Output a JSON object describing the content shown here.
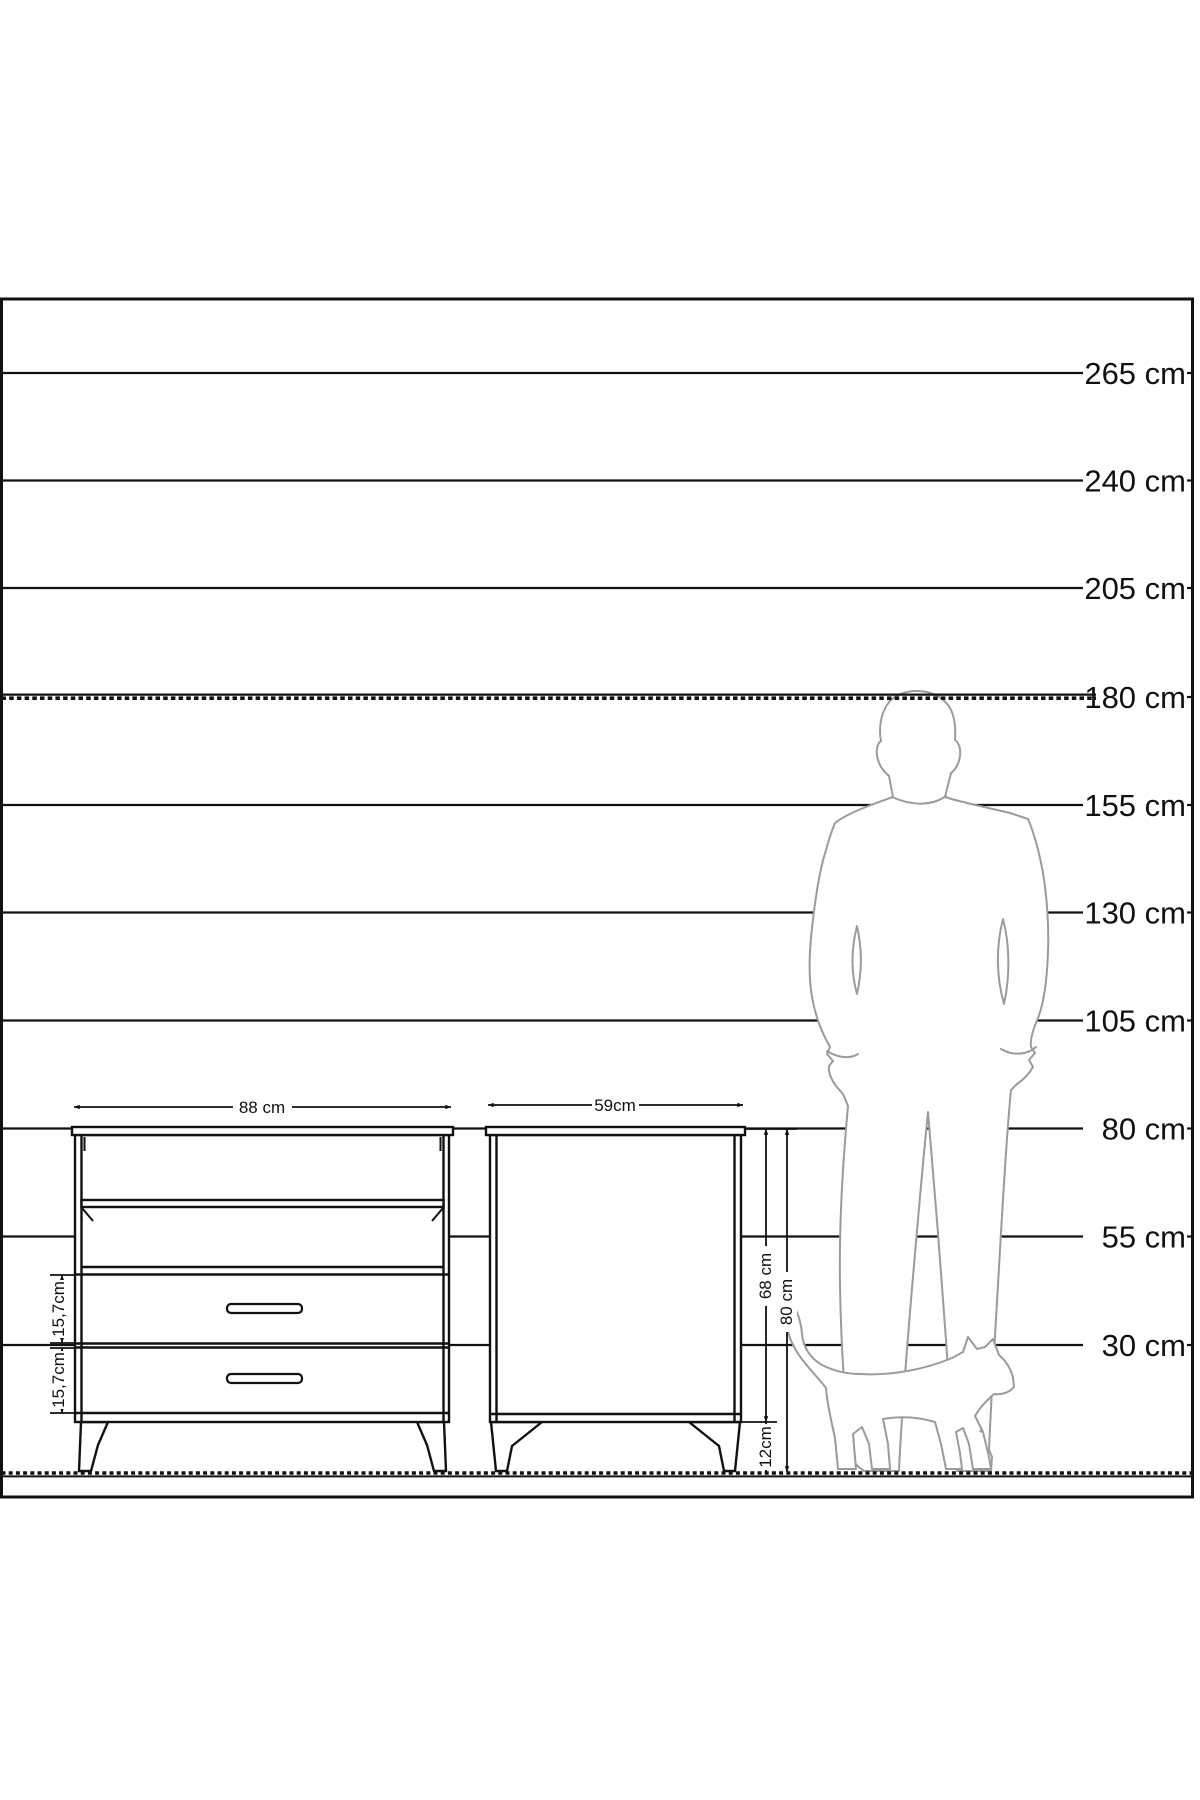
{
  "diagram": {
    "type": "furniture-dimension-scale-diagram",
    "height_scale": {
      "unit": "cm",
      "labels": [
        "265 cm",
        "240 cm",
        "205 cm",
        "180 cm",
        "155 cm",
        "130 cm",
        "105 cm",
        "80 cm",
        "55 cm",
        "30 cm"
      ],
      "dashed_reference_line": "180 cm",
      "floor_line": "0 cm (floor, dashed)"
    },
    "dresser": {
      "name": "dresser-front-view",
      "width_label": "88 cm",
      "top_drawer_height_label": "15,7cm",
      "bottom_drawer_height_label": "15,7cm",
      "features": [
        "open-shelf-top",
        "open-shelf-middle",
        "two-drawers-with-handles",
        "four-splayed-legs"
      ]
    },
    "nightstand": {
      "name": "nightstand-side-view",
      "width_label": "59cm",
      "body_height_label": "68 cm",
      "total_height_label": "80 cm",
      "leg_height_label": "12cm"
    },
    "figures": {
      "man": "man-silhouette-180cm",
      "cat": "cat-silhouette"
    },
    "colors": {
      "line": "#111111",
      "silhouette": "#9b9b9b",
      "background": "#ffffff"
    }
  }
}
